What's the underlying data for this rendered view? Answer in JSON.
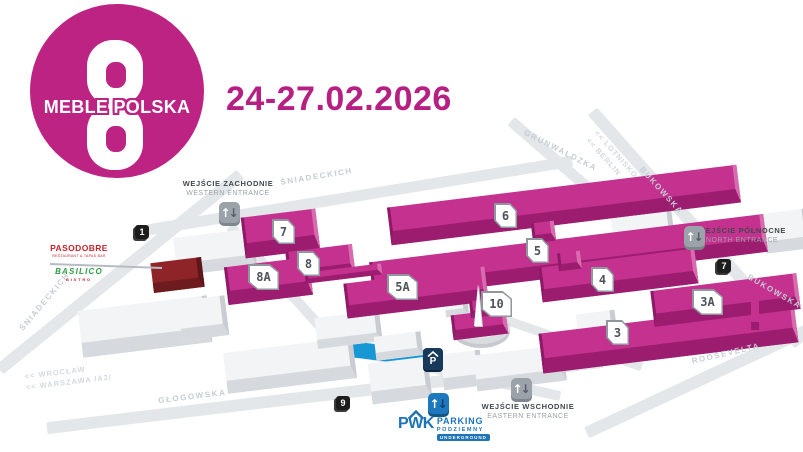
{
  "brand": {
    "logo_text": "MEBLE POLSKA",
    "date": "24-27.02.2026"
  },
  "icons": {
    "up_arrow": "↑",
    "down_arrow": "↓"
  },
  "map": {
    "hall_labels": [
      "6",
      "5",
      "5A",
      "4",
      "10",
      "3",
      "3A",
      "7",
      "8",
      "8A"
    ],
    "road_markers": [
      "1",
      "7",
      "9"
    ],
    "entrances": {
      "west": {
        "pl": "WEJŚCIE ZACHODNIE",
        "en": "WESTERN ENTRANCE"
      },
      "north": {
        "pl": "WEJŚCIE PÓŁNOCNE",
        "en": "NORTH ENTRANCE"
      },
      "east": {
        "pl": "WEJŚCIE WSCHODNIE",
        "en": "EASTERN ENTRANCE"
      }
    },
    "streets": {
      "sniadeckich_top": "ŚNIADECKICH",
      "sniadeckich_left": "ŚNIADECKICH",
      "grunwaldzka": "GRUNWALDZKA",
      "bukowska_upper": "BUKOWSKA",
      "bukowska_lower": "BUKOWSKA",
      "roosevelta": "ROOSEVELTA",
      "glogowska": "GŁOGOWSKA"
    },
    "directions": {
      "lotnisko": "<< LOTNISKO",
      "berlin": "<< BERLIN",
      "wroclaw": "<< WROCŁAW",
      "warszawa": "<< WARSZAWA /A2/"
    },
    "restaurants": {
      "pasodobre": "PASODOBRE",
      "pasodobre_sub": "RESTAURANT & TAPAS BAR",
      "basilico": "BASILICO",
      "basilico_sub": "BISTRO"
    },
    "parking": {
      "badge": "P",
      "brand": "PWK",
      "line1": "PARKING",
      "line2": "PODZIEMNY",
      "line3": "UNDERGROUND"
    },
    "colors": {
      "accent": "#bc2383",
      "hall_top": "#c5318f",
      "hall_front": "#9c1d70",
      "road": "#e3e7ea",
      "underground_blue": "#1897d5",
      "pwk_blue": "#1d74b8"
    }
  }
}
